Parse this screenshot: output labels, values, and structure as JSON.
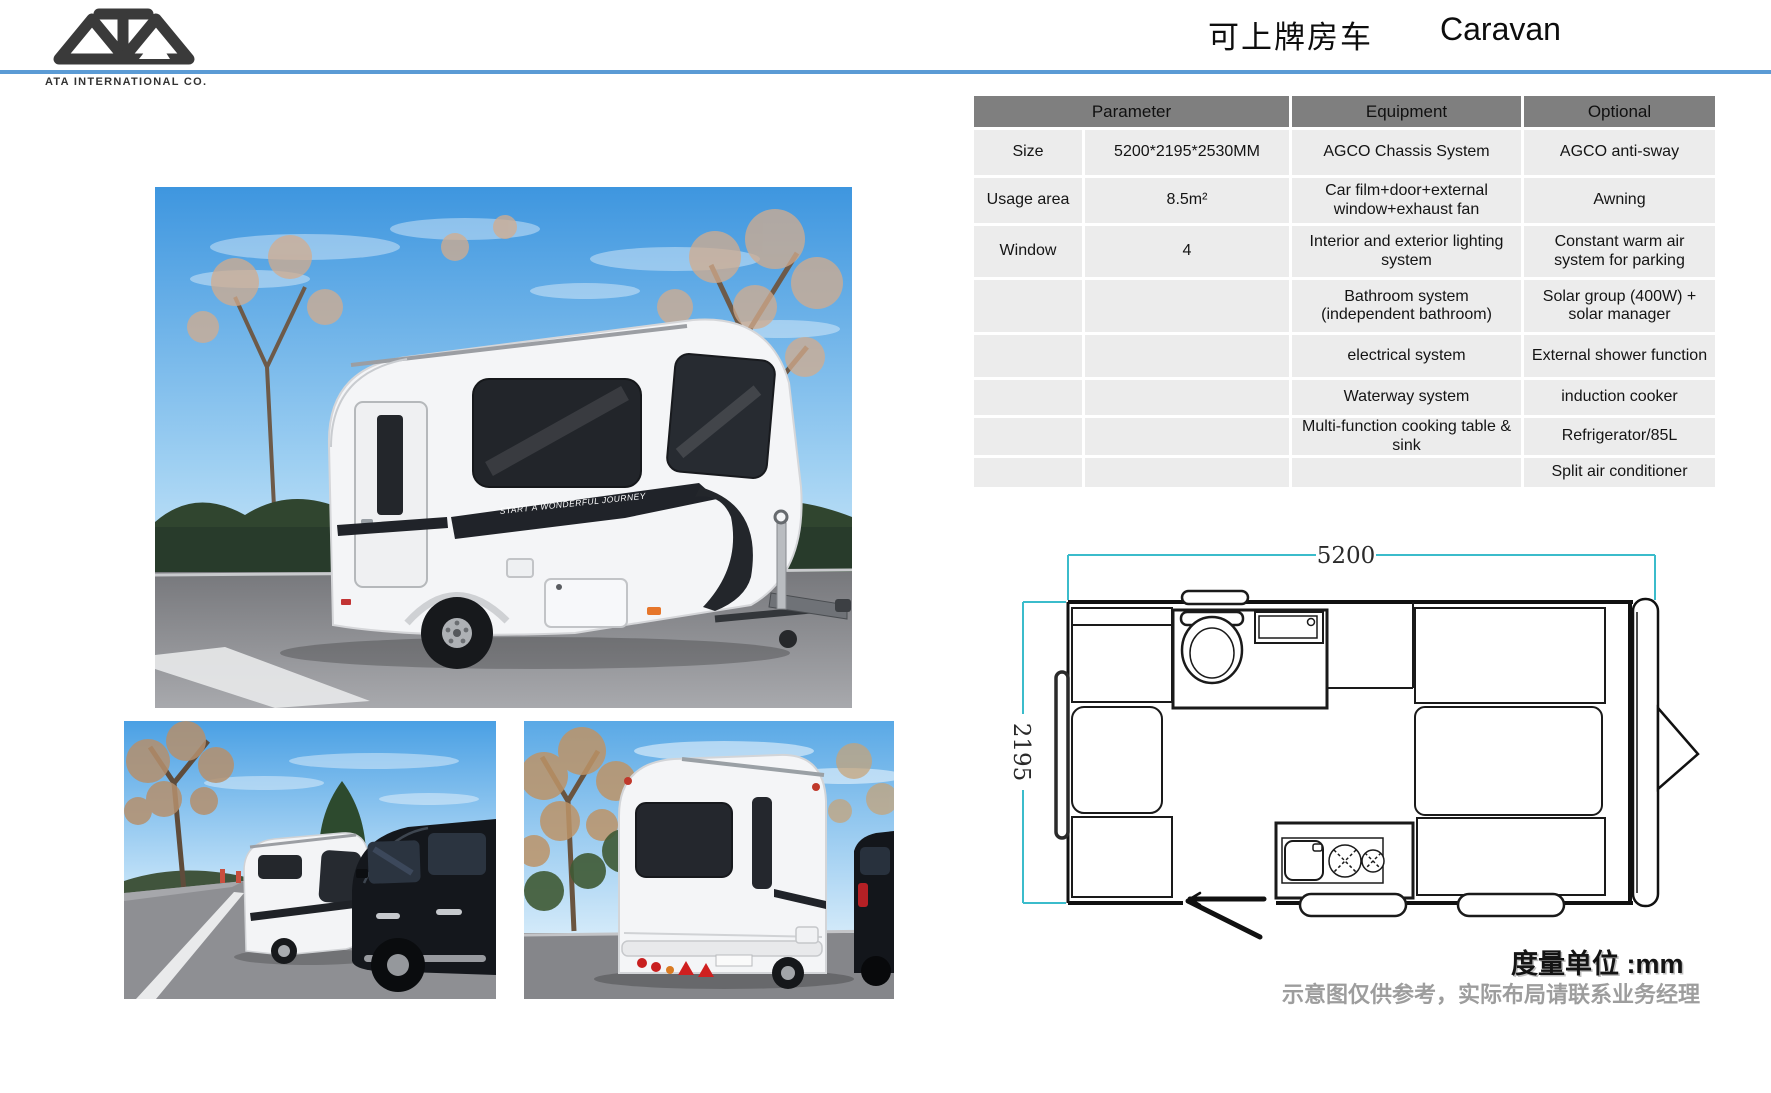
{
  "page": {
    "company_name": "ATA INTERNATIONAL CO.",
    "title_cn": "可上牌房车",
    "title_en": "Caravan",
    "accent_color": "#5b9bd5"
  },
  "spec_table": {
    "headers": {
      "parameter": "Parameter",
      "equipment": "Equipment",
      "optional": "Optional"
    },
    "rows": [
      {
        "label": "Size",
        "value": "5200*2195*2530MM",
        "equipment": "AGCO Chassis System",
        "optional": "AGCO anti-sway"
      },
      {
        "label": "Usage area",
        "value": "8.5m²",
        "equipment": "Car film+door+external window+exhaust fan",
        "optional": "Awning"
      },
      {
        "label": "Window",
        "value": "4",
        "equipment": "Interior and exterior lighting system",
        "optional": "Constant warm air system for parking"
      },
      {
        "label": "",
        "value": "",
        "equipment": "Bathroom system (independent bathroom)",
        "optional": "Solar group (400W) + solar manager"
      },
      {
        "label": "",
        "value": "",
        "equipment": "electrical system",
        "optional": "External shower function"
      },
      {
        "label": "",
        "value": "",
        "equipment": "Waterway system",
        "optional": "induction cooker"
      },
      {
        "label": "",
        "value": "",
        "equipment": "Multi-function cooking table & sink",
        "optional": "Refrigerator/85L"
      },
      {
        "label": "",
        "value": "",
        "equipment": "",
        "optional": "Split air conditioner"
      }
    ]
  },
  "floor_plan": {
    "length_label": "5200",
    "width_label": "2195",
    "unit_note": "度量单位 :mm",
    "disclaimer": "示意图仅供参考，实际布局请联系业务经理",
    "dimension_color": "#3bbccb"
  },
  "photos": {
    "stripe_text": "START A WONDERFUL JOURNEY"
  }
}
